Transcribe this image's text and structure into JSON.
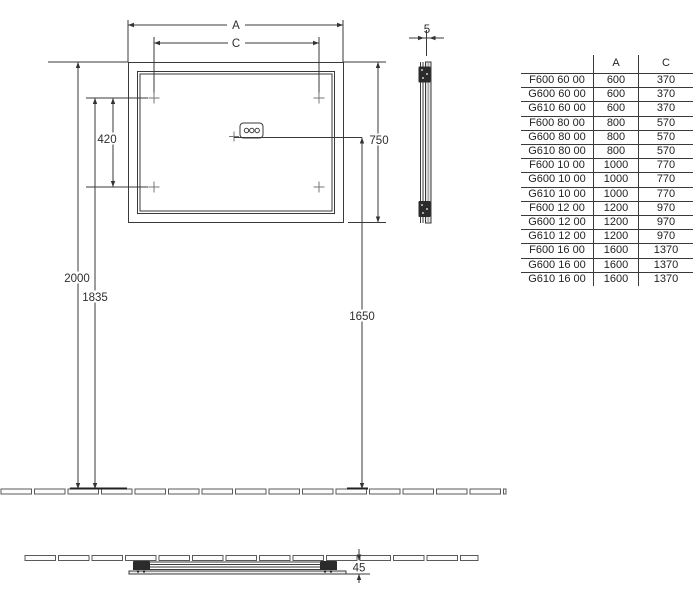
{
  "dimensions": {
    "width_label": "A",
    "mount_width_label": "C",
    "mount_vertical_spacing": "420",
    "mirror_height": "750",
    "total_height": "2000",
    "mount_height": "1835",
    "control_height": "1650",
    "glass_thickness": "5",
    "wall_depth": "45"
  },
  "table": {
    "headers": {
      "model": "",
      "a": "A",
      "c": "C"
    },
    "rows": [
      {
        "model": "F600 60 00",
        "a": "600",
        "c": "370"
      },
      {
        "model": "G600 60 00",
        "a": "600",
        "c": "370"
      },
      {
        "model": "G610 60 00",
        "a": "600",
        "c": "370"
      },
      {
        "model": "F600 80 00",
        "a": "800",
        "c": "570"
      },
      {
        "model": "G600 80 00",
        "a": "800",
        "c": "570"
      },
      {
        "model": "G610 80 00",
        "a": "800",
        "c": "570"
      },
      {
        "model": "F600 10 00",
        "a": "1000",
        "c": "770"
      },
      {
        "model": "G600 10 00",
        "a": "1000",
        "c": "770"
      },
      {
        "model": "G610 10 00",
        "a": "1000",
        "c": "770"
      },
      {
        "model": "F600 12 00",
        "a": "1200",
        "c": "970"
      },
      {
        "model": "G600 12 00",
        "a": "1200",
        "c": "970"
      },
      {
        "model": "G610 12 00",
        "a": "1200",
        "c": "970"
      },
      {
        "model": "F600 16 00",
        "a": "1600",
        "c": "1370"
      },
      {
        "model": "G600 16 00",
        "a": "1600",
        "c": "1370"
      },
      {
        "model": "G610 16 00",
        "a": "1600",
        "c": "1370"
      }
    ]
  },
  "colors": {
    "line": "#3a3a3a",
    "text": "#2e2e2e",
    "background": "#ffffff"
  }
}
